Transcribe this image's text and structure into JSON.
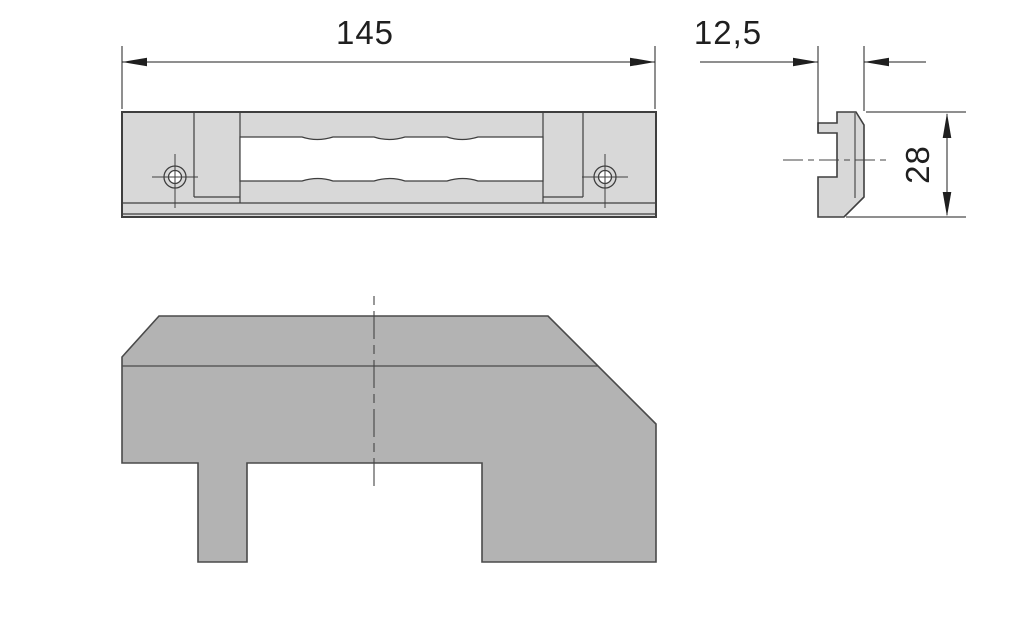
{
  "dimensions": {
    "width": "145",
    "thickness": "12,5",
    "height": "28"
  },
  "colors": {
    "part_fill_front": "#d8d8d8",
    "part_fill_bottom": "#b3b3b3",
    "outline": "#3f3f3f",
    "bottom_outline": "#4a4a4a",
    "dimension_line": "#1f1f1f",
    "background": "#ffffff"
  }
}
